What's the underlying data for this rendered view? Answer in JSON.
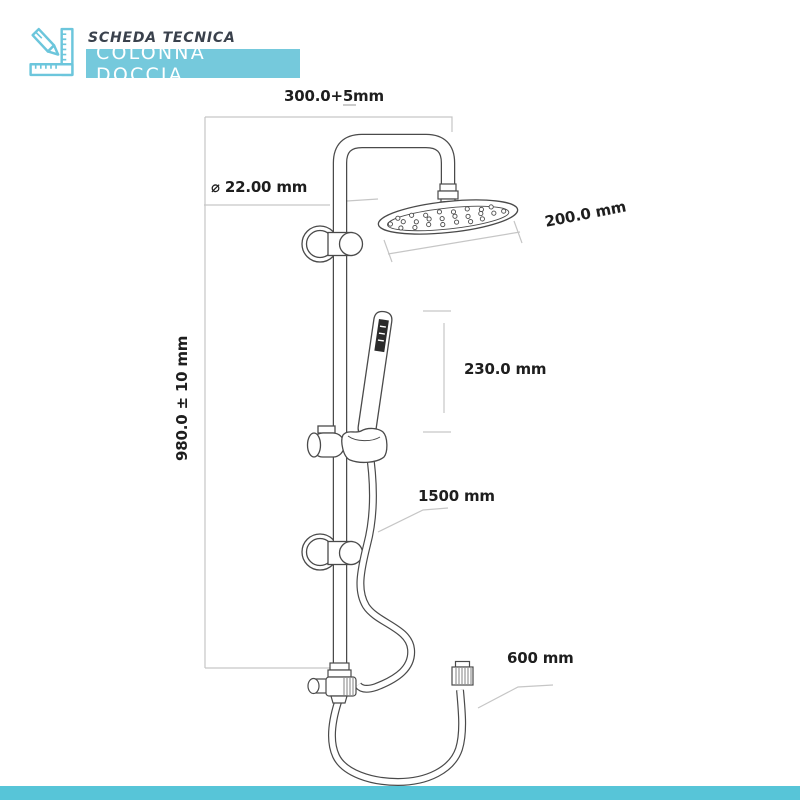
{
  "header": {
    "eyebrow": "SCHEDA TECNICA",
    "banner": "COLONNA DOCCIA",
    "icon": "pencil-ruler-icon"
  },
  "diagram": {
    "subject": "shower column technical drawing",
    "labels": {
      "top_width": "300.0+5mm",
      "pipe_diameter": "⌀ 22.00 mm",
      "head_width": "200.0 mm",
      "hand_shower_length": "230.0 mm",
      "column_height": "980.0 ± 10 mm",
      "shower_hose_length": "1500 mm",
      "outlet_hose_length": "600 mm"
    }
  },
  "colors": {
    "banner_bg": "#75c9dc",
    "bottom_bar": "#57c5d8",
    "icon_blue": "#6cc6dc",
    "drawing_line": "#4a4a4a",
    "dimension_line": "#c6c6c6",
    "label_text": "#1e1e1e",
    "eyebrow_text": "#3a414c"
  }
}
